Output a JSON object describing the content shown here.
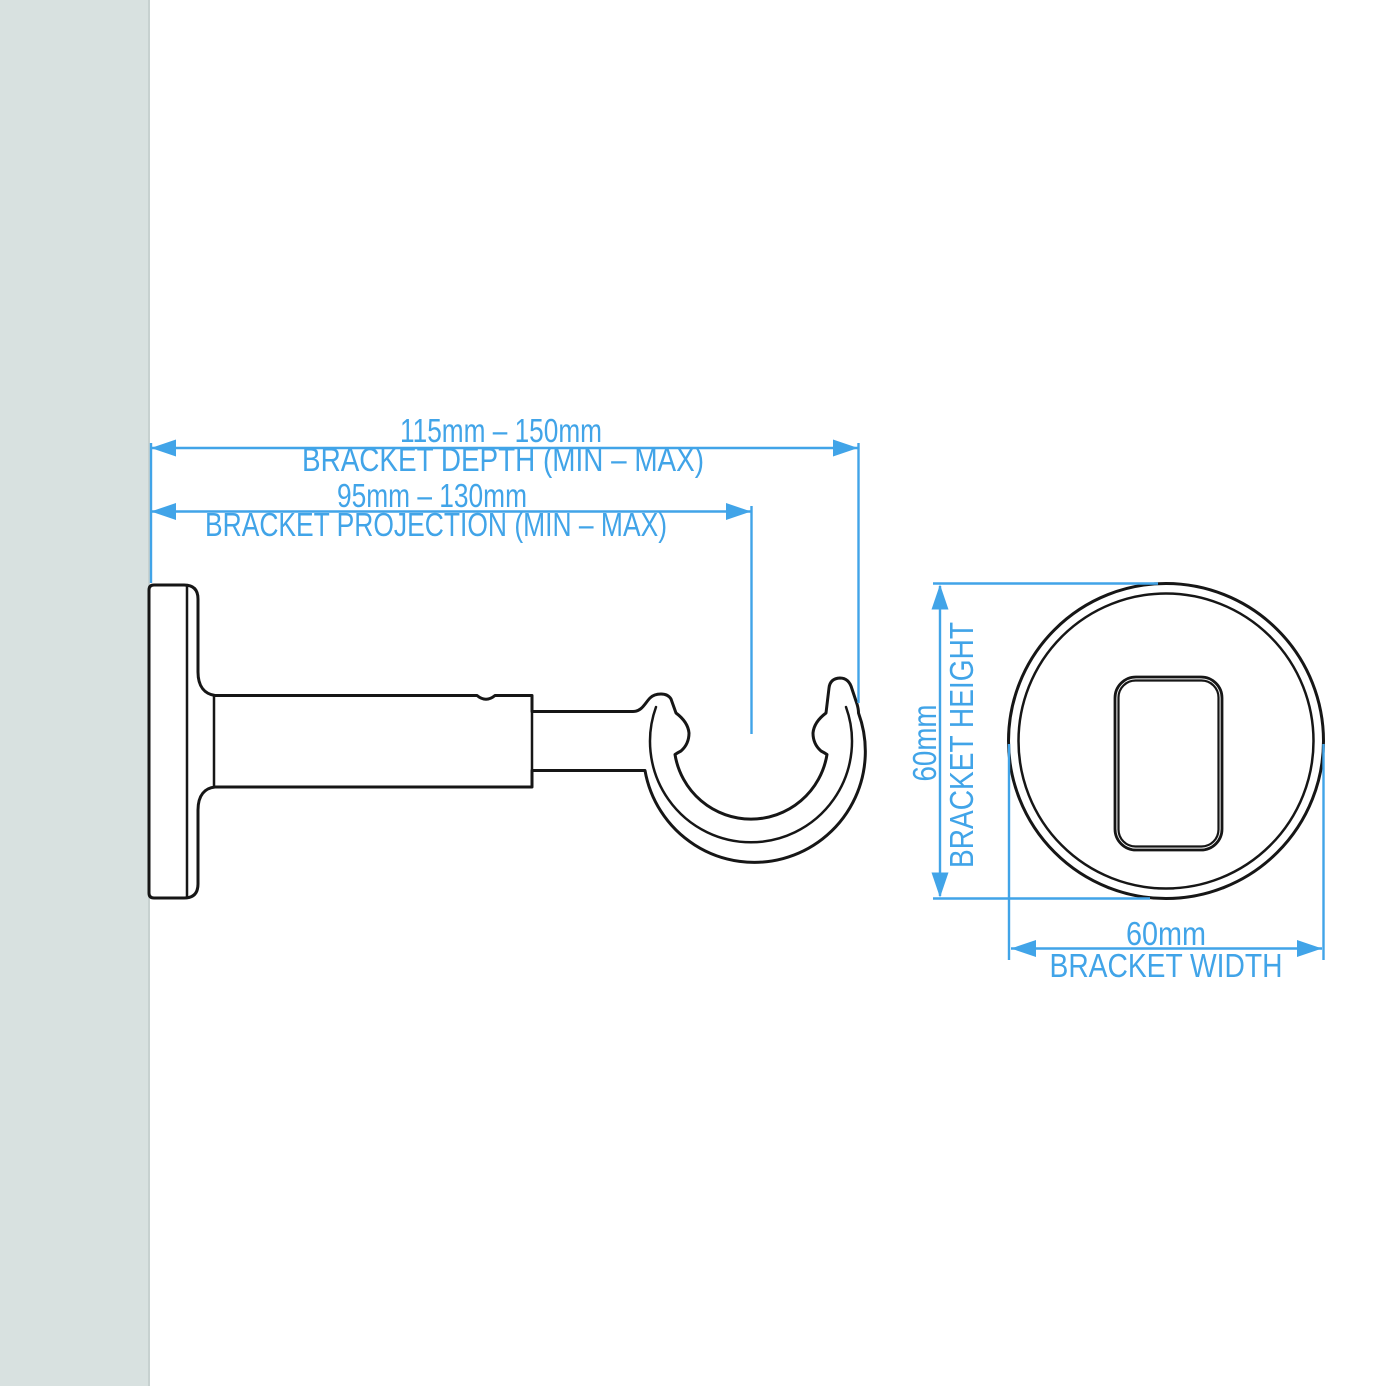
{
  "colors": {
    "accent": "#41a4e8",
    "line": "#161616",
    "wall": "#d8e1e0",
    "wall_edge": "#c7d1d0",
    "bg": "#ffffff"
  },
  "side_view": {
    "depth": {
      "value": "115mm – 150mm",
      "label": "BRACKET DEPTH (MIN – MAX)"
    },
    "projection": {
      "value": "95mm – 130mm",
      "label": "BRACKET PROJECTION (MIN – MAX)"
    }
  },
  "front_view": {
    "height": {
      "value": "60mm",
      "label": "BRACKET HEIGHT"
    },
    "width": {
      "value": "60mm",
      "label": "BRACKET WIDTH"
    }
  }
}
